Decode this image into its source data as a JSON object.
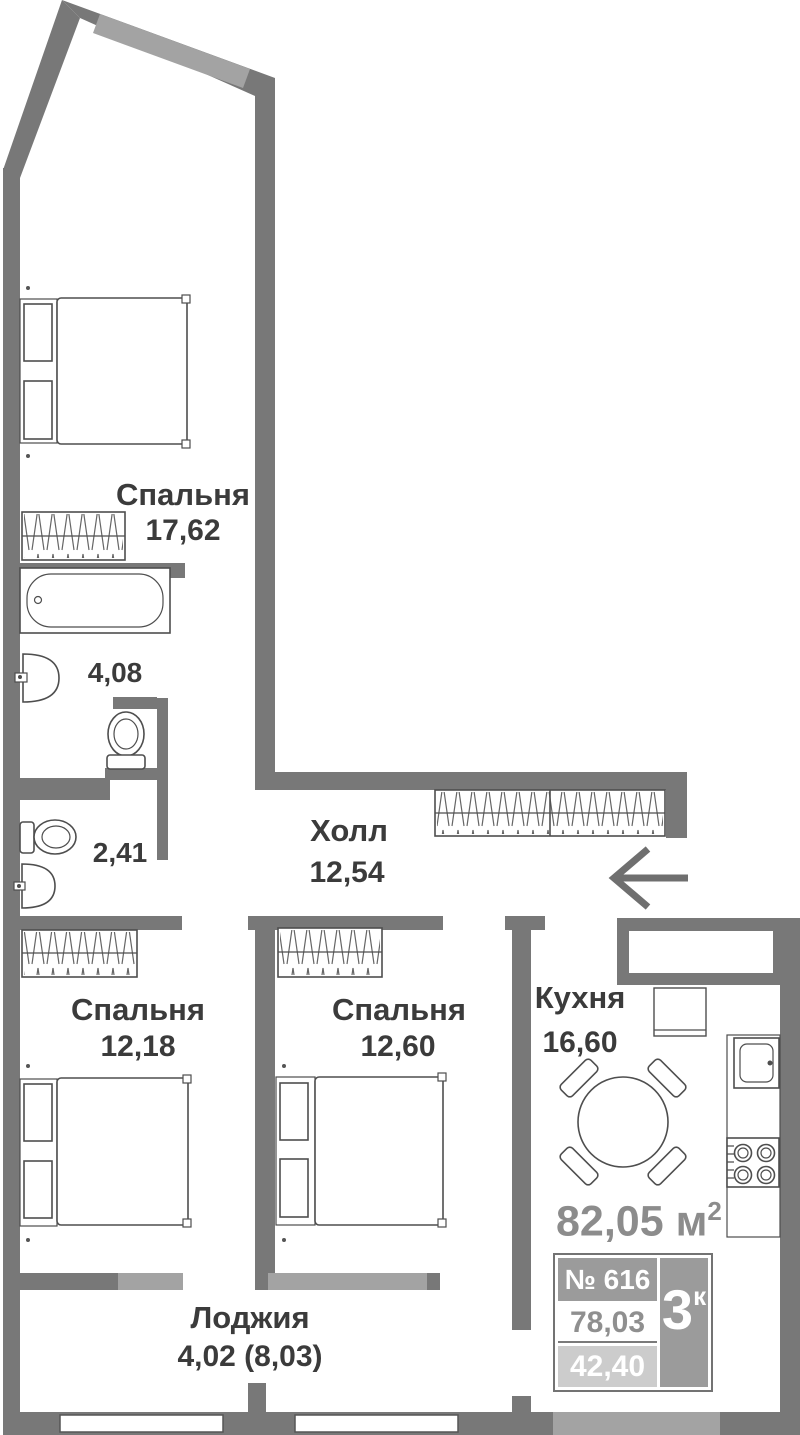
{
  "plan_title": "apartment-floor-plan",
  "rooms": {
    "bedroom_main": {
      "name": "Спальня",
      "area": "17,62"
    },
    "bathroom": {
      "area": "4,08"
    },
    "wc": {
      "area": "2,41"
    },
    "hall": {
      "name": "Холл",
      "area": "12,54"
    },
    "bedroom_left": {
      "name": "Спальня",
      "area": "12,18"
    },
    "bedroom_mid": {
      "name": "Спальня",
      "area": "12,60"
    },
    "kitchen": {
      "name": "Кухня",
      "area": "16,60"
    },
    "loggia": {
      "name": "Лоджия",
      "area": "4,02 (8,03)"
    }
  },
  "total_area": {
    "value": "82,05",
    "unit": "м",
    "sup": "2"
  },
  "info_badge": {
    "number": "№ 616",
    "rooms_value": "3",
    "rooms_suffix": "к",
    "area_total": "78,03",
    "area_living": "42,40"
  },
  "icons": {
    "furniture": [
      "double-bed",
      "nightstand",
      "wardrobe",
      "bathtub",
      "toilet",
      "sink",
      "dining-table",
      "chair",
      "kitchen-cabinet",
      "kitchen-sink",
      "stove",
      "entrance-arrow"
    ]
  },
  "colors": {
    "wall": "#787878",
    "window_band": "#a3a3a3",
    "furniture_line": "#4e4e4e",
    "label_text": "#3b3b3b",
    "muted_text": "#8c8c8c",
    "badge_gray": "#9b9b9b",
    "badge_light_gray": "#cccccc",
    "badge_border": "#737373"
  }
}
